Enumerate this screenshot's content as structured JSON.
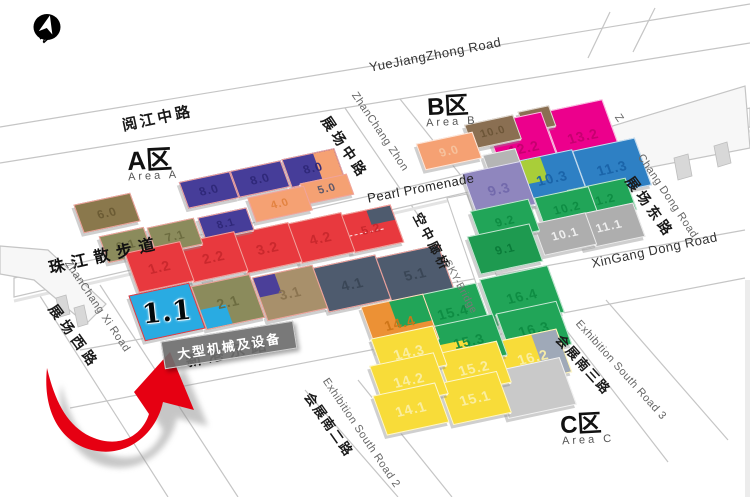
{
  "compass": {
    "label": "N"
  },
  "areas": {
    "a": {
      "title": "A区",
      "subtitle": "Area A"
    },
    "b": {
      "title": "B区",
      "subtitle": "Area B"
    },
    "c": {
      "title": "C区",
      "subtitle": "Area C"
    }
  },
  "highlight": {
    "hall": "1.1",
    "tooltip": "大型机械及设备"
  },
  "colors": {
    "arrow": "#E60012",
    "arrow_shadow": "#8F8F8F",
    "road_line": "#C5C5C5",
    "hall_border_a": "#F0A49E"
  },
  "halls": [
    {
      "label": "6.0",
      "x": 78,
      "y": 198,
      "w": 56,
      "h": 28,
      "fill": "#8A784C",
      "tc": "#6A5A33",
      "border": "#F0A49E"
    },
    {
      "label": "8.0",
      "x": 183,
      "y": 176,
      "w": 50,
      "h": 26,
      "fill": "#463D99",
      "tc": "#2F2878",
      "border": "#F0A49E"
    },
    {
      "label": "8.0",
      "x": 234,
      "y": 165,
      "w": 50,
      "h": 26,
      "fill": "#463D99",
      "tc": "#2F2878",
      "border": "#F0A49E"
    },
    {
      "label": "8.0",
      "x": 286,
      "y": 153,
      "w": 52,
      "h": 28,
      "fill": "#463D99",
      "tc": "#2F2878",
      "border": "#F0A49E",
      "patch": {
        "pos": "right",
        "color": "#F5A173",
        "w": 40,
        "h": 100
      }
    },
    {
      "label": "4.0",
      "x": 251,
      "y": 191,
      "w": 56,
      "h": 24,
      "fill": "#F5A173",
      "tc": "#E2823F",
      "border": "#F0A49E"
    },
    {
      "label": "5.0",
      "x": 303,
      "y": 178,
      "w": 46,
      "h": 20,
      "fill": "#F5A173",
      "tc": "#55556B",
      "border": "#F0A49E"
    },
    {
      "label": "6.1",
      "x": 103,
      "y": 231,
      "w": 44,
      "h": 26,
      "fill": "#8B8B5C",
      "tc": "#6B6B3F",
      "border": "#F0A49E"
    },
    {
      "label": "7.1",
      "x": 151,
      "y": 222,
      "w": 46,
      "h": 26,
      "fill": "#8B8B5C",
      "tc": "#6B6B3F",
      "border": "#F0A49E"
    },
    {
      "label": "8.1",
      "x": 201,
      "y": 212,
      "w": 48,
      "h": 22,
      "fill": "#463D99",
      "tc": "#2F2878",
      "border": "#F0A49E"
    },
    {
      "label": "1.2",
      "x": 131,
      "y": 246,
      "w": 55,
      "h": 40,
      "fill": "#E8393E",
      "tc": "#C9282D",
      "border": "#F0A49E"
    },
    {
      "label": "2.2",
      "x": 185,
      "y": 236,
      "w": 55,
      "h": 40,
      "fill": "#E8393E",
      "tc": "#C9282D",
      "border": "#F0A49E"
    },
    {
      "label": "3.2",
      "x": 239,
      "y": 227,
      "w": 55,
      "h": 40,
      "fill": "#E8393E",
      "tc": "#C9282D",
      "border": "#F0A49E"
    },
    {
      "label": "4.2",
      "x": 292,
      "y": 217,
      "w": 55,
      "h": 40,
      "fill": "#E8393E",
      "tc": "#C9282D",
      "border": "#F0A49E"
    },
    {
      "label": "5.2",
      "x": 344,
      "y": 209,
      "w": 52,
      "h": 38,
      "fill": "#E8393E",
      "tc": "#C9282D",
      "border": "#F0A49E",
      "dash": true,
      "patch": {
        "pos": "corner-tr",
        "color": "#4E5B6E",
        "w": 46,
        "h": 40
      }
    },
    {
      "label": "1.1",
      "x": 136,
      "y": 288,
      "w": 60,
      "h": 46,
      "fill": "#29ABE2",
      "tc": "#000000",
      "border": "#E8393E",
      "big": true
    },
    {
      "label": "2.1",
      "x": 198,
      "y": 279,
      "w": 58,
      "h": 44,
      "fill": "#8B8B5C",
      "tc": "#6B6B3F",
      "border": "#F0A49E",
      "patch": {
        "pos": "corner-bl",
        "color": "#29ABE2",
        "w": 44,
        "h": 46
      }
    },
    {
      "label": "3.1",
      "x": 259,
      "y": 270,
      "w": 60,
      "h": 44,
      "fill": "#A8906B",
      "tc": "#8A7350",
      "border": "#F0A49E",
      "patch": {
        "pos": "corner-tl",
        "color": "#4B3F99",
        "w": 36,
        "h": 46
      }
    },
    {
      "label": "4.1",
      "x": 320,
      "y": 260,
      "w": 62,
      "h": 45,
      "fill": "#4E5B6E",
      "tc": "#394655",
      "border": "#F0A49E"
    },
    {
      "label": "5.1",
      "x": 383,
      "y": 250,
      "w": 62,
      "h": 45,
      "fill": "#4E5B6E",
      "tc": "#394655",
      "border": "#F0A49E"
    },
    {
      "label": "9.0",
      "x": 420,
      "y": 137,
      "w": 56,
      "h": 26,
      "fill": "#F5A173",
      "tc": "#F6C4A0"
    },
    {
      "label": "10.0",
      "x": 468,
      "y": 119,
      "w": 48,
      "h": 24,
      "fill": "#8A6F52",
      "tc": "#6B5436"
    },
    {
      "label": "",
      "x": 521,
      "y": 108,
      "w": 30,
      "h": 20,
      "fill": "#8A6F52"
    },
    {
      "label": "",
      "x": 486,
      "y": 151,
      "w": 32,
      "h": 22,
      "fill": "#B5B5B5"
    },
    {
      "label": "12.2",
      "x": 495,
      "y": 116,
      "w": 56,
      "h": 62,
      "fill": "#EC008C",
      "tc": "#C4006F"
    },
    {
      "label": "13.2",
      "x": 552,
      "y": 104,
      "w": 60,
      "h": 62,
      "fill": "#EC008C",
      "tc": "#C4006F"
    },
    {
      "label": "9.3",
      "x": 469,
      "y": 166,
      "w": 58,
      "h": 44,
      "fill": "#8F86BE",
      "tc": "#7168AB"
    },
    {
      "label": "10.3",
      "x": 523,
      "y": 154,
      "w": 56,
      "h": 46,
      "fill": "#2E80C4",
      "tc": "#1A63A8",
      "patch": {
        "pos": "corner-tl",
        "color": "#A9CE39",
        "w": 42,
        "h": 52
      }
    },
    {
      "label": "11.3",
      "x": 580,
      "y": 143,
      "w": 62,
      "h": 48,
      "fill": "#2E80C4",
      "tc": "#1A63A8"
    },
    {
      "label": "9.2",
      "x": 475,
      "y": 204,
      "w": 58,
      "h": 32,
      "fill": "#21A558",
      "tc": "#0E8C43"
    },
    {
      "label": "10.2",
      "x": 539,
      "y": 191,
      "w": 54,
      "h": 32,
      "fill": "#21A558",
      "tc": "#0E8C43"
    },
    {
      "label": "11.2",
      "x": 572,
      "y": 183,
      "w": 58,
      "h": 32,
      "fill": "#21A558",
      "tc": "#0E8C43"
    },
    {
      "label": "9.1",
      "x": 473,
      "y": 229,
      "w": 62,
      "h": 38,
      "fill": "#1E9A50",
      "tc": "#0A7A38"
    },
    {
      "label": "10.1",
      "x": 538,
      "y": 217,
      "w": 52,
      "h": 32,
      "fill": "#AEAEAE",
      "tc": "#F2F2F2"
    },
    {
      "label": "11.1",
      "x": 578,
      "y": 208,
      "w": 60,
      "h": 34,
      "fill": "#AEAEAE",
      "tc": "#F2F2F2"
    },
    {
      "label": "14.4",
      "x": 368,
      "y": 299,
      "w": 62,
      "h": 46,
      "fill": "#EC9135",
      "tc": "#CE7518",
      "patch": {
        "pos": "corner-tr",
        "color": "#21A558",
        "w": 55,
        "h": 58
      }
    },
    {
      "label": "15.4",
      "x": 421,
      "y": 288,
      "w": 62,
      "h": 46,
      "fill": "#21A558",
      "tc": "#0E8C43"
    },
    {
      "label": "16.4",
      "x": 487,
      "y": 271,
      "w": 68,
      "h": 48,
      "fill": "#21A558",
      "tc": "#0E8C43"
    },
    {
      "label": "14.3",
      "x": 377,
      "y": 331,
      "w": 62,
      "h": 40,
      "fill": "#F8DC39",
      "tc": "#FAEFA6"
    },
    {
      "label": "15.3",
      "x": 437,
      "y": 319,
      "w": 62,
      "h": 42,
      "fill": "#21A558",
      "tc": "#0E8C43",
      "patch": {
        "pos": "corner-bl",
        "color": "#F8DC39",
        "w": 46,
        "h": 55
      }
    },
    {
      "label": "16.3",
      "x": 503,
      "y": 306,
      "w": 60,
      "h": 44,
      "fill": "#21A558",
      "tc": "#0E8C43"
    },
    {
      "label": "14.2",
      "x": 376,
      "y": 358,
      "w": 64,
      "h": 42,
      "fill": "#F8DC39",
      "tc": "#FAEFA6"
    },
    {
      "label": "15.2",
      "x": 443,
      "y": 346,
      "w": 60,
      "h": 42,
      "fill": "#F8DC39",
      "tc": "#FAEFA6"
    },
    {
      "label": "16.2",
      "x": 501,
      "y": 334,
      "w": 62,
      "h": 44,
      "fill": "#F8DC39",
      "tc": "#FAEFA6",
      "patch": {
        "pos": "right",
        "color": "#9FA9B8",
        "w": 40,
        "h": 100
      }
    },
    {
      "label": "14.1",
      "x": 379,
      "y": 388,
      "w": 62,
      "h": 40,
      "fill": "#F8DC39",
      "tc": "#FAEFA6"
    },
    {
      "label": "15.1",
      "x": 445,
      "y": 376,
      "w": 58,
      "h": 42,
      "fill": "#F8DC39",
      "tc": "#FAEFA6"
    },
    {
      "label": "",
      "x": 499,
      "y": 363,
      "w": 68,
      "h": 48,
      "fill": "#C9C9C9"
    }
  ],
  "road_labels": [
    {
      "text": "阅江中路",
      "x": 120,
      "y": 115,
      "rot": -12,
      "size": 15,
      "bold": true,
      "color": "#1A1A1A",
      "ls": 3
    },
    {
      "text": "YueJiangZhong Road",
      "x": 368,
      "y": 60,
      "rot": -11,
      "size": 13,
      "bold": false,
      "color": "#333333",
      "ls": 0.5
    },
    {
      "text": "展场中路",
      "x": 333,
      "y": 112,
      "rot": 56,
      "size": 14,
      "bold": true,
      "color": "#1A1A1A",
      "ls": 4
    },
    {
      "text": "ZhanChang Zhon",
      "x": 359,
      "y": 90,
      "rot": 56,
      "size": 11,
      "bold": false,
      "color": "#666666",
      "ls": 0.5
    },
    {
      "text": "Pearl Promenade",
      "x": 366,
      "y": 191,
      "rot": -11,
      "size": 13,
      "bold": false,
      "color": "#222222",
      "ls": 0.5
    },
    {
      "text": "珠江散步道",
      "x": 46,
      "y": 255,
      "rot": -13,
      "size": 16,
      "bold": true,
      "color": "#111111",
      "ls": 7
    },
    {
      "text": "空中廊桥",
      "x": 426,
      "y": 209,
      "rot": 62,
      "size": 13,
      "bold": true,
      "color": "#1A1A1A",
      "ls": 3
    },
    {
      "text": "SKY-Bridge",
      "x": 452,
      "y": 258,
      "rot": 62,
      "size": 10.5,
      "bold": false,
      "color": "#777777",
      "ls": 0.5
    },
    {
      "text": "ZhanChang Xi Road",
      "x": 72,
      "y": 258,
      "rot": 56,
      "size": 11,
      "bold": false,
      "color": "#666666",
      "ls": 0.5
    },
    {
      "text": "展场西路",
      "x": 60,
      "y": 300,
      "rot": 54,
      "size": 14,
      "bold": true,
      "color": "#1A1A1A",
      "ls": 5
    },
    {
      "text": "新港东路",
      "x": 183,
      "y": 348,
      "rot": -12,
      "size": 16,
      "bold": true,
      "color": "#1A1A1A",
      "ls": 6
    },
    {
      "text": "XinGang Dong Road",
      "x": 590,
      "y": 256,
      "rot": -12,
      "size": 13,
      "bold": false,
      "color": "#333333",
      "ls": 0.5
    },
    {
      "text": "Z",
      "x": 622,
      "y": 112,
      "rot": 56,
      "size": 11,
      "bold": false,
      "color": "#666666",
      "ls": 0
    },
    {
      "text": "Chang Dong Road",
      "x": 645,
      "y": 152,
      "rot": 56,
      "size": 11,
      "bold": false,
      "color": "#666666",
      "ls": 0.5
    },
    {
      "text": "展场东路",
      "x": 637,
      "y": 172,
      "rot": 54,
      "size": 14,
      "bold": true,
      "color": "#1A1A1A",
      "ls": 4
    },
    {
      "text": "Exhibition South Road 2",
      "x": 330,
      "y": 376,
      "rot": 56,
      "size": 11,
      "bold": false,
      "color": "#666666",
      "ls": 0.5
    },
    {
      "text": "会展南二路",
      "x": 316,
      "y": 388,
      "rot": 55,
      "size": 13,
      "bold": true,
      "color": "#1A1A1A",
      "ls": 2
    },
    {
      "text": "Exhibition South Road 3",
      "x": 582,
      "y": 318,
      "rot": 48,
      "size": 11,
      "bold": false,
      "color": "#666666",
      "ls": 0.5
    },
    {
      "text": "会展南三路",
      "x": 566,
      "y": 330,
      "rot": 48,
      "size": 13,
      "bold": true,
      "color": "#1A1A1A",
      "ls": 2
    }
  ]
}
